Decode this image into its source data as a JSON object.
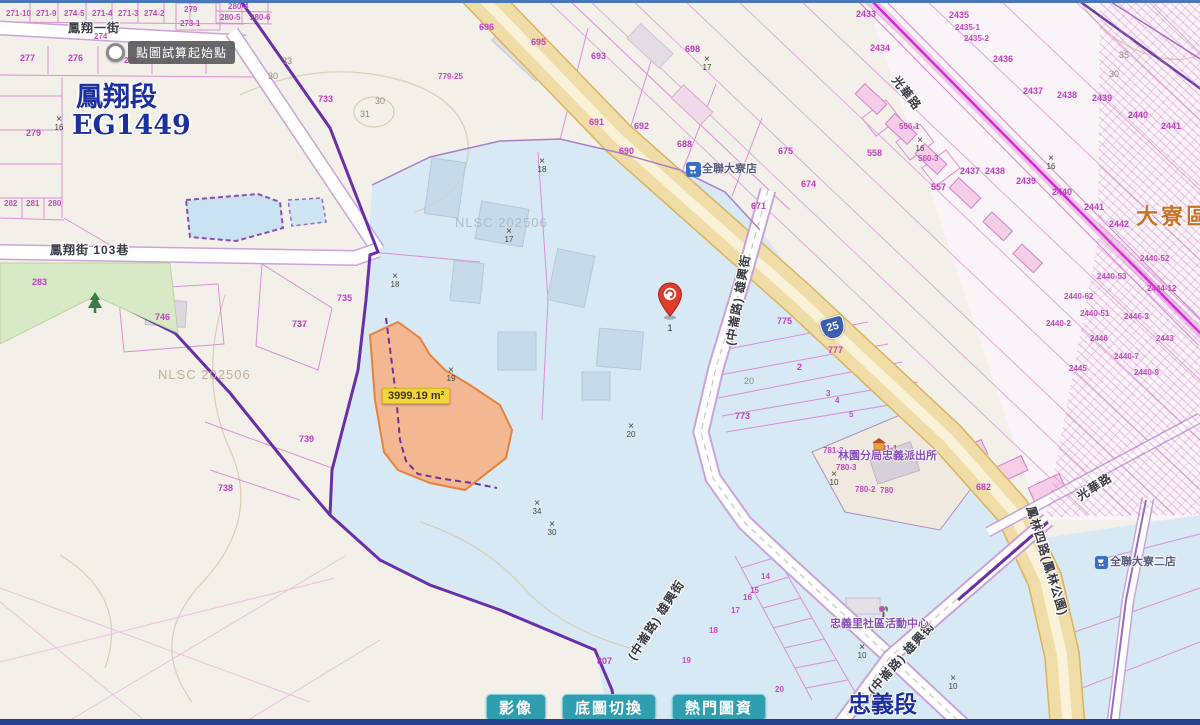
{
  "map": {
    "tooltip": "點圖試算起始點",
    "area_label": "3999.19 m²",
    "pin_label": "1",
    "route_shield": "25",
    "watermark": "NLSC 202506",
    "cross_glyph": "×",
    "labels": [
      {
        "t": "271-10",
        "x": 6,
        "y": 10,
        "c": "p2"
      },
      {
        "t": "271-9",
        "x": 36,
        "y": 10,
        "c": "p2"
      },
      {
        "t": "274-5",
        "x": 64,
        "y": 10,
        "c": "p2"
      },
      {
        "t": "271-4",
        "x": 92,
        "y": 10,
        "c": "p2"
      },
      {
        "t": "271-3",
        "x": 118,
        "y": 10,
        "c": "p2"
      },
      {
        "t": "274-2",
        "x": 144,
        "y": 10,
        "c": "p2"
      },
      {
        "t": "279",
        "x": 184,
        "y": 6,
        "c": "p2"
      },
      {
        "t": "273-1",
        "x": 180,
        "y": 20,
        "c": "p2"
      },
      {
        "t": "280-4",
        "x": 228,
        "y": 3,
        "c": "p2"
      },
      {
        "t": "280-5",
        "x": 220,
        "y": 14,
        "c": "p2"
      },
      {
        "t": "280-6",
        "x": 250,
        "y": 14,
        "c": "p2"
      },
      {
        "t": "274",
        "x": 94,
        "y": 33,
        "c": "p2"
      },
      {
        "t": "277",
        "x": 20,
        "y": 54,
        "c": "p"
      },
      {
        "t": "276",
        "x": 68,
        "y": 54,
        "c": "p"
      },
      {
        "t": "278-1",
        "x": 124,
        "y": 57,
        "c": "p2"
      },
      {
        "t": "279",
        "x": 167,
        "y": 57,
        "c": "p2"
      },
      {
        "t": "282",
        "x": 4,
        "y": 200,
        "c": "p2"
      },
      {
        "t": "281",
        "x": 26,
        "y": 200,
        "c": "p2"
      },
      {
        "t": "280",
        "x": 48,
        "y": 200,
        "c": "p2"
      },
      {
        "t": "279",
        "x": 26,
        "y": 129,
        "c": "p"
      },
      {
        "t": "283",
        "x": 32,
        "y": 278,
        "c": "p"
      },
      {
        "t": "746",
        "x": 155,
        "y": 313,
        "c": "p"
      },
      {
        "t": "733",
        "x": 318,
        "y": 95,
        "c": "p"
      },
      {
        "t": "735",
        "x": 337,
        "y": 294,
        "c": "p"
      },
      {
        "t": "737",
        "x": 292,
        "y": 320,
        "c": "p"
      },
      {
        "t": "739",
        "x": 299,
        "y": 435,
        "c": "p"
      },
      {
        "t": "738",
        "x": 218,
        "y": 484,
        "c": "p"
      },
      {
        "t": "807",
        "x": 597,
        "y": 657,
        "c": "p"
      },
      {
        "t": "779-25",
        "x": 438,
        "y": 73,
        "c": "p2"
      },
      {
        "t": "696",
        "x": 479,
        "y": 23,
        "c": "p"
      },
      {
        "t": "695",
        "x": 531,
        "y": 38,
        "c": "p"
      },
      {
        "t": "693",
        "x": 591,
        "y": 52,
        "c": "p"
      },
      {
        "t": "698",
        "x": 685,
        "y": 45,
        "c": "p"
      },
      {
        "t": "691",
        "x": 589,
        "y": 118,
        "c": "p"
      },
      {
        "t": "692",
        "x": 634,
        "y": 122,
        "c": "p"
      },
      {
        "t": "690",
        "x": 619,
        "y": 147,
        "c": "p"
      },
      {
        "t": "688",
        "x": 677,
        "y": 140,
        "c": "p"
      },
      {
        "t": "675",
        "x": 778,
        "y": 147,
        "c": "p"
      },
      {
        "t": "674",
        "x": 801,
        "y": 180,
        "c": "p"
      },
      {
        "t": "671",
        "x": 751,
        "y": 202,
        "c": "p"
      },
      {
        "t": "556-1",
        "x": 899,
        "y": 123,
        "c": "p2"
      },
      {
        "t": "558",
        "x": 867,
        "y": 149,
        "c": "p"
      },
      {
        "t": "560-3",
        "x": 918,
        "y": 155,
        "c": "p2"
      },
      {
        "t": "557",
        "x": 931,
        "y": 183,
        "c": "p"
      },
      {
        "t": "2433",
        "x": 856,
        "y": 10,
        "c": "p"
      },
      {
        "t": "2434",
        "x": 870,
        "y": 44,
        "c": "p"
      },
      {
        "t": "2435",
        "x": 949,
        "y": 11,
        "c": "p"
      },
      {
        "t": "2435-1",
        "x": 955,
        "y": 24,
        "c": "p2"
      },
      {
        "t": "2435-2",
        "x": 964,
        "y": 35,
        "c": "p2"
      },
      {
        "t": "2436",
        "x": 993,
        "y": 55,
        "c": "p"
      },
      {
        "t": "2437",
        "x": 1023,
        "y": 87,
        "c": "p"
      },
      {
        "t": "2438",
        "x": 1057,
        "y": 91,
        "c": "p"
      },
      {
        "t": "2439",
        "x": 1092,
        "y": 94,
        "c": "p"
      },
      {
        "t": "2440",
        "x": 1128,
        "y": 111,
        "c": "p"
      },
      {
        "t": "2441",
        "x": 1161,
        "y": 122,
        "c": "p"
      },
      {
        "t": "2437",
        "x": 960,
        "y": 167,
        "c": "p"
      },
      {
        "t": "2438",
        "x": 985,
        "y": 167,
        "c": "p"
      },
      {
        "t": "2439",
        "x": 1016,
        "y": 177,
        "c": "p"
      },
      {
        "t": "2440",
        "x": 1052,
        "y": 188,
        "c": "p"
      },
      {
        "t": "2441",
        "x": 1084,
        "y": 203,
        "c": "p"
      },
      {
        "t": "2442",
        "x": 1109,
        "y": 220,
        "c": "p"
      },
      {
        "t": "2440-52",
        "x": 1140,
        "y": 255,
        "c": "p2"
      },
      {
        "t": "2440-53",
        "x": 1097,
        "y": 273,
        "c": "p2"
      },
      {
        "t": "2444-12",
        "x": 1147,
        "y": 285,
        "c": "p2"
      },
      {
        "t": "2440-62",
        "x": 1064,
        "y": 293,
        "c": "p2"
      },
      {
        "t": "2440-51",
        "x": 1080,
        "y": 310,
        "c": "p2"
      },
      {
        "t": "2446-3",
        "x": 1124,
        "y": 313,
        "c": "p2"
      },
      {
        "t": "2440-2",
        "x": 1046,
        "y": 320,
        "c": "p2"
      },
      {
        "t": "2446",
        "x": 1090,
        "y": 335,
        "c": "p2"
      },
      {
        "t": "2443",
        "x": 1156,
        "y": 335,
        "c": "p2"
      },
      {
        "t": "2440-7",
        "x": 1114,
        "y": 353,
        "c": "p2"
      },
      {
        "t": "2445",
        "x": 1069,
        "y": 365,
        "c": "p2"
      },
      {
        "t": "2440-9",
        "x": 1134,
        "y": 369,
        "c": "p2"
      },
      {
        "t": "775",
        "x": 777,
        "y": 317,
        "c": "p"
      },
      {
        "t": "777",
        "x": 828,
        "y": 346,
        "c": "p"
      },
      {
        "t": "773",
        "x": 735,
        "y": 412,
        "c": "p"
      },
      {
        "t": "2",
        "x": 797,
        "y": 363,
        "c": "p"
      },
      {
        "t": "3",
        "x": 826,
        "y": 390,
        "c": "p2"
      },
      {
        "t": "4",
        "x": 835,
        "y": 397,
        "c": "p2"
      },
      {
        "t": "5",
        "x": 849,
        "y": 411,
        "c": "p2"
      },
      {
        "t": "781-3",
        "x": 823,
        "y": 447,
        "c": "p2"
      },
      {
        "t": "781-1",
        "x": 877,
        "y": 445,
        "c": "p2"
      },
      {
        "t": "780-3",
        "x": 836,
        "y": 464,
        "c": "p2"
      },
      {
        "t": "780-2",
        "x": 855,
        "y": 486,
        "c": "p2"
      },
      {
        "t": "780",
        "x": 880,
        "y": 487,
        "c": "p2"
      },
      {
        "t": "682",
        "x": 976,
        "y": 483,
        "c": "p"
      },
      {
        "t": "14",
        "x": 761,
        "y": 573,
        "c": "p2"
      },
      {
        "t": "15",
        "x": 750,
        "y": 587,
        "c": "p2"
      },
      {
        "t": "16",
        "x": 743,
        "y": 594,
        "c": "p2"
      },
      {
        "t": "17",
        "x": 731,
        "y": 607,
        "c": "p2"
      },
      {
        "t": "18",
        "x": 709,
        "y": 627,
        "c": "p2"
      },
      {
        "t": "19",
        "x": 682,
        "y": 657,
        "c": "p2"
      },
      {
        "t": "20",
        "x": 775,
        "y": 686,
        "c": "p2"
      },
      {
        "t": "鳳翔一街",
        "x": 68,
        "y": 22,
        "c": "st",
        "n": "street-label"
      },
      {
        "t": "鳳翔街 103巷",
        "x": 50,
        "y": 244,
        "c": "st",
        "n": "street-label"
      },
      {
        "t": "(中崙路) 雄興街",
        "x": 692,
        "y": 294,
        "c": "st",
        "r": -80,
        "n": "street-label"
      },
      {
        "t": "(中崙路) 雄興街",
        "x": 610,
        "y": 614,
        "c": "st",
        "r": -57,
        "n": "street-label"
      },
      {
        "t": "(中崙路) 雄興街",
        "x": 855,
        "y": 652,
        "c": "st",
        "r": -48,
        "n": "street-label"
      },
      {
        "t": "鳳林四路(鳳林公園)",
        "x": 990,
        "y": 555,
        "c": "st",
        "r": 73,
        "n": "street-label"
      },
      {
        "t": "光華路",
        "x": 1075,
        "y": 481,
        "c": "st",
        "r": -33,
        "n": "street-label"
      },
      {
        "t": "光華路",
        "x": 887,
        "y": 87,
        "c": "st",
        "r": 52,
        "n": "street-label"
      },
      {
        "t": "林園分局忠義派出所",
        "x": 838,
        "y": 451,
        "c": "poi",
        "n": "police-station-label"
      },
      {
        "t": "忠義里社區活動中心",
        "x": 830,
        "y": 619,
        "c": "poi",
        "n": "community-center-label"
      },
      {
        "t": "全聯大寮店",
        "x": 702,
        "y": 164,
        "c": "poidark",
        "n": "store-label"
      },
      {
        "t": "全聯大寮二店",
        "x": 1110,
        "y": 557,
        "c": "poidark",
        "n": "store-label"
      },
      {
        "t": "鳳翔段",
        "x": 76,
        "y": 84,
        "c": "big",
        "n": "section-name"
      },
      {
        "t": "EG1449",
        "x": 72,
        "y": 112,
        "c": "big",
        "n": "section-code"
      },
      {
        "t": "忠義段",
        "x": 848,
        "y": 693,
        "c": "big2",
        "n": "section-name"
      },
      {
        "t": "大寮區",
        "x": 1136,
        "y": 206,
        "c": "ochre",
        "n": "district-name"
      },
      {
        "t": "30",
        "x": 375,
        "y": 97,
        "c": "gray"
      },
      {
        "t": "31",
        "x": 360,
        "y": 110,
        "c": "gray"
      },
      {
        "t": "33",
        "x": 282,
        "y": 57,
        "c": "gray"
      },
      {
        "t": "30",
        "x": 268,
        "y": 72,
        "c": "gray"
      },
      {
        "t": "20",
        "x": 744,
        "y": 377,
        "c": "gray"
      },
      {
        "t": "35",
        "x": 1119,
        "y": 51,
        "c": "gray"
      },
      {
        "t": "30",
        "x": 1109,
        "y": 70,
        "c": "gray"
      }
    ],
    "crosses": [
      {
        "x": 50,
        "y": 116,
        "n": "16"
      },
      {
        "x": 533,
        "y": 158,
        "n": "18"
      },
      {
        "x": 698,
        "y": 56,
        "n": "17"
      },
      {
        "x": 911,
        "y": 137,
        "n": "16"
      },
      {
        "x": 1042,
        "y": 155,
        "n": "16"
      },
      {
        "x": 386,
        "y": 273,
        "n": "18"
      },
      {
        "x": 500,
        "y": 228,
        "n": "17"
      },
      {
        "x": 442,
        "y": 367,
        "n": "19"
      },
      {
        "x": 622,
        "y": 423,
        "n": "20"
      },
      {
        "x": 528,
        "y": 500,
        "n": "34"
      },
      {
        "x": 543,
        "y": 521,
        "n": "30"
      },
      {
        "x": 825,
        "y": 471,
        "n": "10"
      },
      {
        "x": 853,
        "y": 644,
        "n": "10"
      },
      {
        "x": 944,
        "y": 675,
        "n": "10"
      }
    ]
  },
  "toolbar": {
    "buttons": [
      {
        "label": "影像",
        "name": "imagery-button"
      },
      {
        "label": "底圖切換",
        "name": "basemap-switch-button"
      },
      {
        "label": "熱門圖資",
        "name": "popular-layers-button"
      }
    ]
  }
}
